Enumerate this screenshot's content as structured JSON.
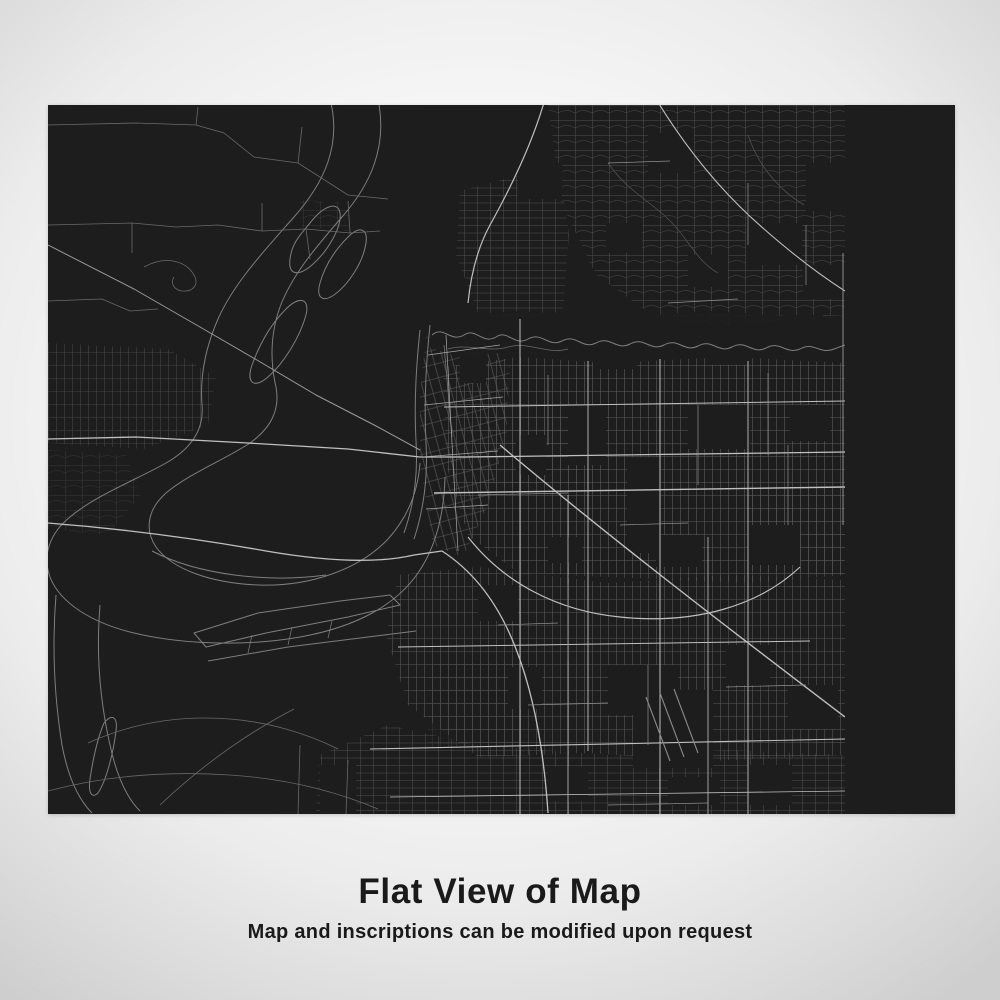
{
  "map_label": {
    "city": "MEMPHIS",
    "inscription": "TENNESSEE / 35.15°N 90.05°W"
  },
  "caption": {
    "title": "Flat View of Map",
    "subtitle": "Map and inscriptions can be modified upon request"
  },
  "colors": {
    "panel-bg": "#1d1d1d",
    "city-text": "#c6c6c6",
    "inscription-text": "#979797",
    "rule-color": "#8d8d8d",
    "caption-text": "#1a1a1a",
    "road-minor": "#5d5d5d",
    "road-major": "#c0c0c0",
    "water-line": "#7e7e7e"
  }
}
